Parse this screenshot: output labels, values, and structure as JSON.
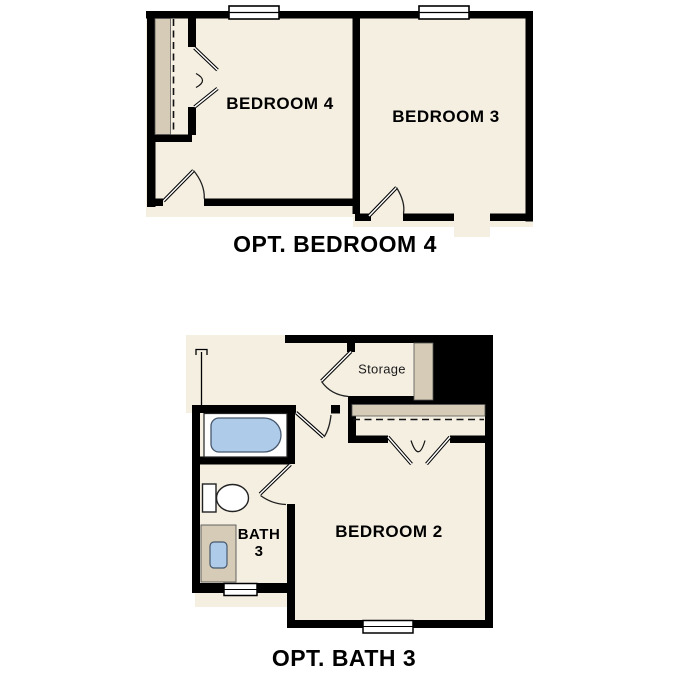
{
  "canvas": {
    "width": 687,
    "height": 687,
    "background": "#ffffff"
  },
  "palette": {
    "floor": "#f5efe2",
    "wall": "#000000",
    "millwork_tan": "#d6cbb6",
    "fixture_blue": "#aecbe9",
    "line": "#222222"
  },
  "plans": [
    {
      "caption": "OPT. BEDROOM 4",
      "rooms": {
        "bedroom4": "BEDROOM 4",
        "bedroom3": "BEDROOM 3"
      }
    },
    {
      "caption": "OPT. BATH 3",
      "rooms": {
        "storage": "Storage",
        "bath_line1": "BATH",
        "bath_line2": "3",
        "bedroom2": "BEDROOM 2"
      }
    }
  ]
}
